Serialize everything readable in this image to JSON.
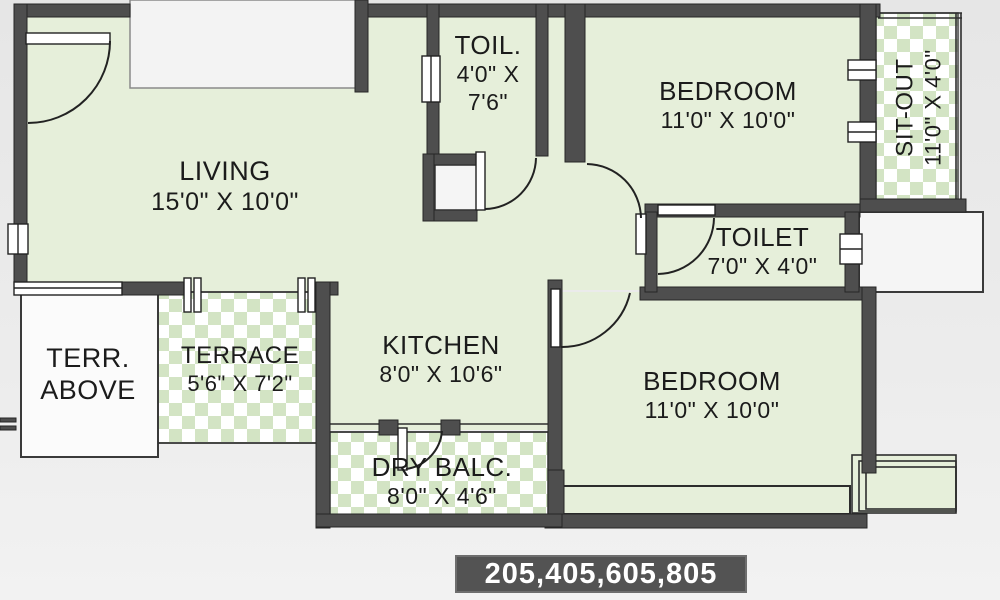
{
  "plan": {
    "colors": {
      "wall": "#4e4e4e",
      "room_fill": "#e6efda",
      "checker_green": "#d3e4c4",
      "outside_white": "#f3f3f3",
      "text": "#1b1b1b",
      "badge_bg": "#535353",
      "badge_text": "#ffffff",
      "background": "#eaeaea"
    },
    "rooms": [
      {
        "id": "living",
        "label": "LIVING",
        "dims": "15'0\" X 10'0\""
      },
      {
        "id": "toilet-small",
        "label": "TOIL.",
        "dims": "4'0\" X",
        "dims2": "7'6\""
      },
      {
        "id": "bedroom-top",
        "label": "BEDROOM",
        "dims": "11'0\" X 10'0\""
      },
      {
        "id": "sit-out",
        "label": "SIT-OUT",
        "dims": "11'0\" X 4'0\""
      },
      {
        "id": "toilet",
        "label": "TOILET",
        "dims": "7'0\" X 4'0\""
      },
      {
        "id": "terrace-above",
        "label": "TERR.",
        "dims": "ABOVE"
      },
      {
        "id": "terrace",
        "label": "TERRACE",
        "dims": "5'6\" X 7'2\""
      },
      {
        "id": "kitchen",
        "label": "KITCHEN",
        "dims": "8'0\" X 10'6\""
      },
      {
        "id": "bedroom-bottom",
        "label": "BEDROOM",
        "dims": "11'0\" X 10'0\""
      },
      {
        "id": "dry-balcony",
        "label": "DRY BALC.",
        "dims": "8'0\" X 4'6\""
      }
    ],
    "unit_numbers": "205,405,605,805"
  }
}
